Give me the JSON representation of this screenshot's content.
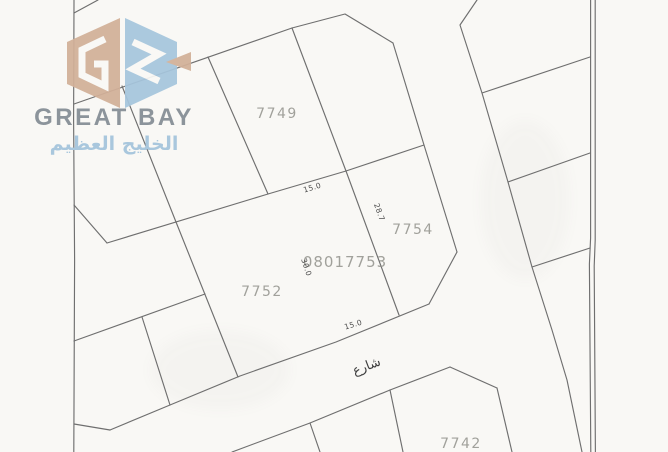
{
  "brand": {
    "name_en": "GREAT BAY",
    "name_ar": "الخليج العظيم",
    "colors": {
      "logo_tan": "#d2b098",
      "logo_blue": "#a6c6dd",
      "name_gray": "#8c949b",
      "arabic_blue": "#a9c7dd"
    }
  },
  "map": {
    "background": "#f9f8f5",
    "line_color": "#6f6f6f",
    "label_color": "#92928c",
    "street_label": "شارع",
    "plot_labels": [
      {
        "id": "7749"
      },
      {
        "id": "7754"
      },
      {
        "id": "7752"
      },
      {
        "id": "08017753"
      },
      {
        "id": "7742"
      }
    ],
    "dimension_labels": [
      {
        "value": "15.0"
      },
      {
        "value": "28.7"
      },
      {
        "value": "30.0"
      },
      {
        "value": "15.0"
      }
    ]
  }
}
